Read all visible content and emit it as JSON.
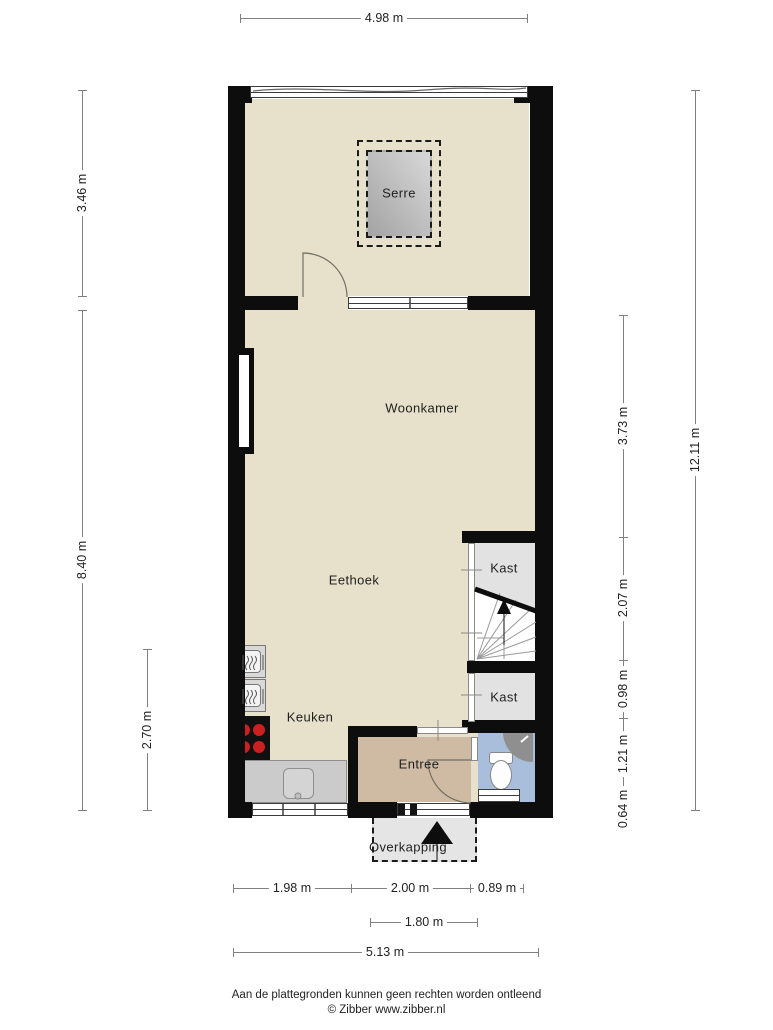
{
  "rooms": {
    "serre": "Serre",
    "woonkamer": "Woonkamer",
    "eethoek": "Eethoek",
    "keuken": "Keuken",
    "kast1": "Kast",
    "kast2": "Kast",
    "entree": "Entree",
    "overkapping": "Overkapping"
  },
  "dimensions": {
    "top_width": "4.98 m",
    "left": {
      "serre_height": "3.46 m",
      "main_height": "8.40 m",
      "kitchen_height": "2.70 m"
    },
    "right": {
      "total_height": "12.11 m",
      "woonkamer": "3.73 m",
      "stairs": "2.07 m",
      "kast": "0.98 m",
      "entree": "1.21 m",
      "porch": "0.64 m"
    },
    "bottom": {
      "kitchen_width": "1.98 m",
      "entree_width": "2.00 m",
      "right_width": "0.89 m",
      "door_width": "1.80 m",
      "total_width": "5.13 m"
    }
  },
  "footer": {
    "disclaimer": "Aan de plattegronden kunnen geen rechten worden ontleend",
    "credit": "© Zibber www.zibber.nl"
  },
  "colors": {
    "wall": "#0d0d0d",
    "floor": "#e7e0ca",
    "closet": "#e2e2e2",
    "entree": "#cfbba3",
    "wc": "#a9bedb",
    "porch": "#e5e5e5",
    "burner": "#cc2020"
  }
}
